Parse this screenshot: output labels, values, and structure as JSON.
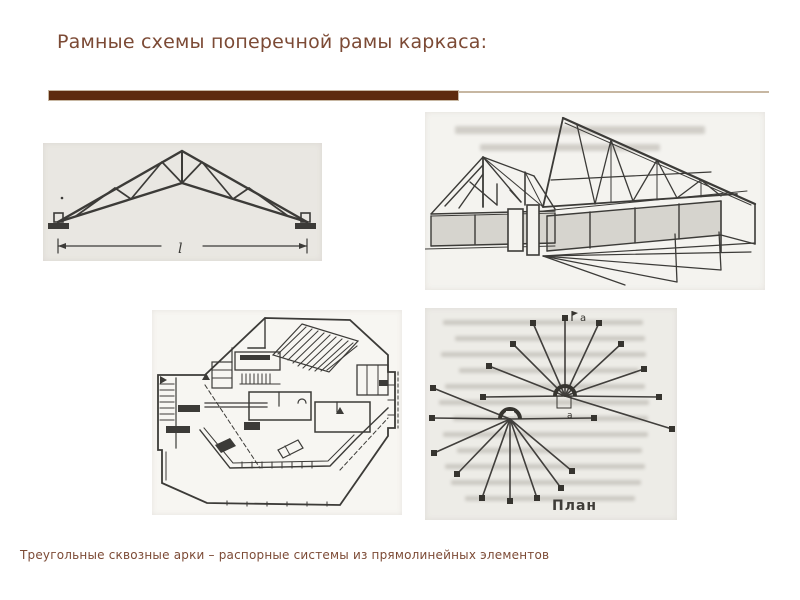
{
  "slide": {
    "title": "Рамные схемы поперечной рамы каркаса:",
    "caption": "Треугольные сквозные арки – распорные системы из прямолинейных элементов",
    "colors": {
      "title_text": "#7c4a35",
      "accent_bar": "#5e2b0e",
      "divider_rule": "#c7b7a2",
      "drawing_ink": "#3c3b38",
      "scan_paper": "#e9e7e2"
    }
  },
  "figures": {
    "truss_arch": {
      "span_label": "l"
    },
    "radial_plan": {
      "plan_label": "План",
      "marker_top": "а",
      "marker_hub": "а"
    }
  }
}
